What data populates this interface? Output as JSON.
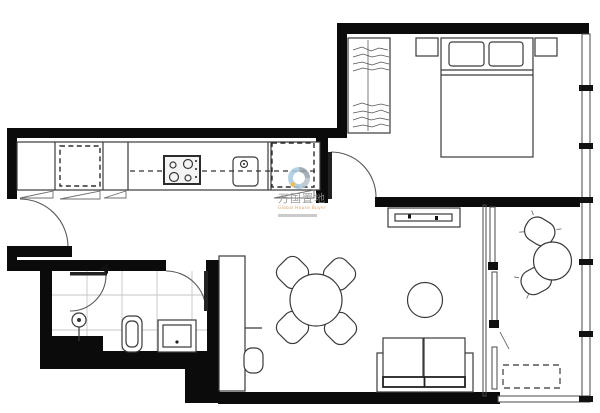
{
  "watermark": {
    "brand": "万国置地",
    "slogan": "Global House Buyer"
  },
  "colors": {
    "wall": "#0b0b0b",
    "line": "#3a3a3a",
    "tile_grid": "#c6c6c6",
    "watermark_text": "#8f8f8f",
    "watermark_accent": "#d8954e",
    "logo_blue": "#a9cbe0",
    "logo_gray": "#98a2aa",
    "logo_yellow": "#e7b43c"
  },
  "plan": {
    "type": "apartment-floor-plan",
    "rooms": [
      "entry",
      "kitchen",
      "bathroom",
      "bedroom",
      "living-dining-room",
      "balcony"
    ],
    "fixtures": [
      "entry-door",
      "kitchen-counter",
      "dishwasher-dashed",
      "cooktop",
      "kitchen-sink",
      "fridge-dashed",
      "bathroom-door",
      "shower-door",
      "shower-head",
      "toilet",
      "washbasin",
      "wardrobe",
      "double-bed",
      "pillows",
      "nightstand-left",
      "nightstand-right",
      "bedroom-door",
      "tv-console",
      "desk",
      "desk-chair",
      "dining-table",
      "dining-chairs",
      "round-rug",
      "sofa",
      "sliding-balcony-door",
      "balcony-chairs",
      "balcony-table",
      "ac-unit-dashed",
      "window-wall"
    ]
  }
}
